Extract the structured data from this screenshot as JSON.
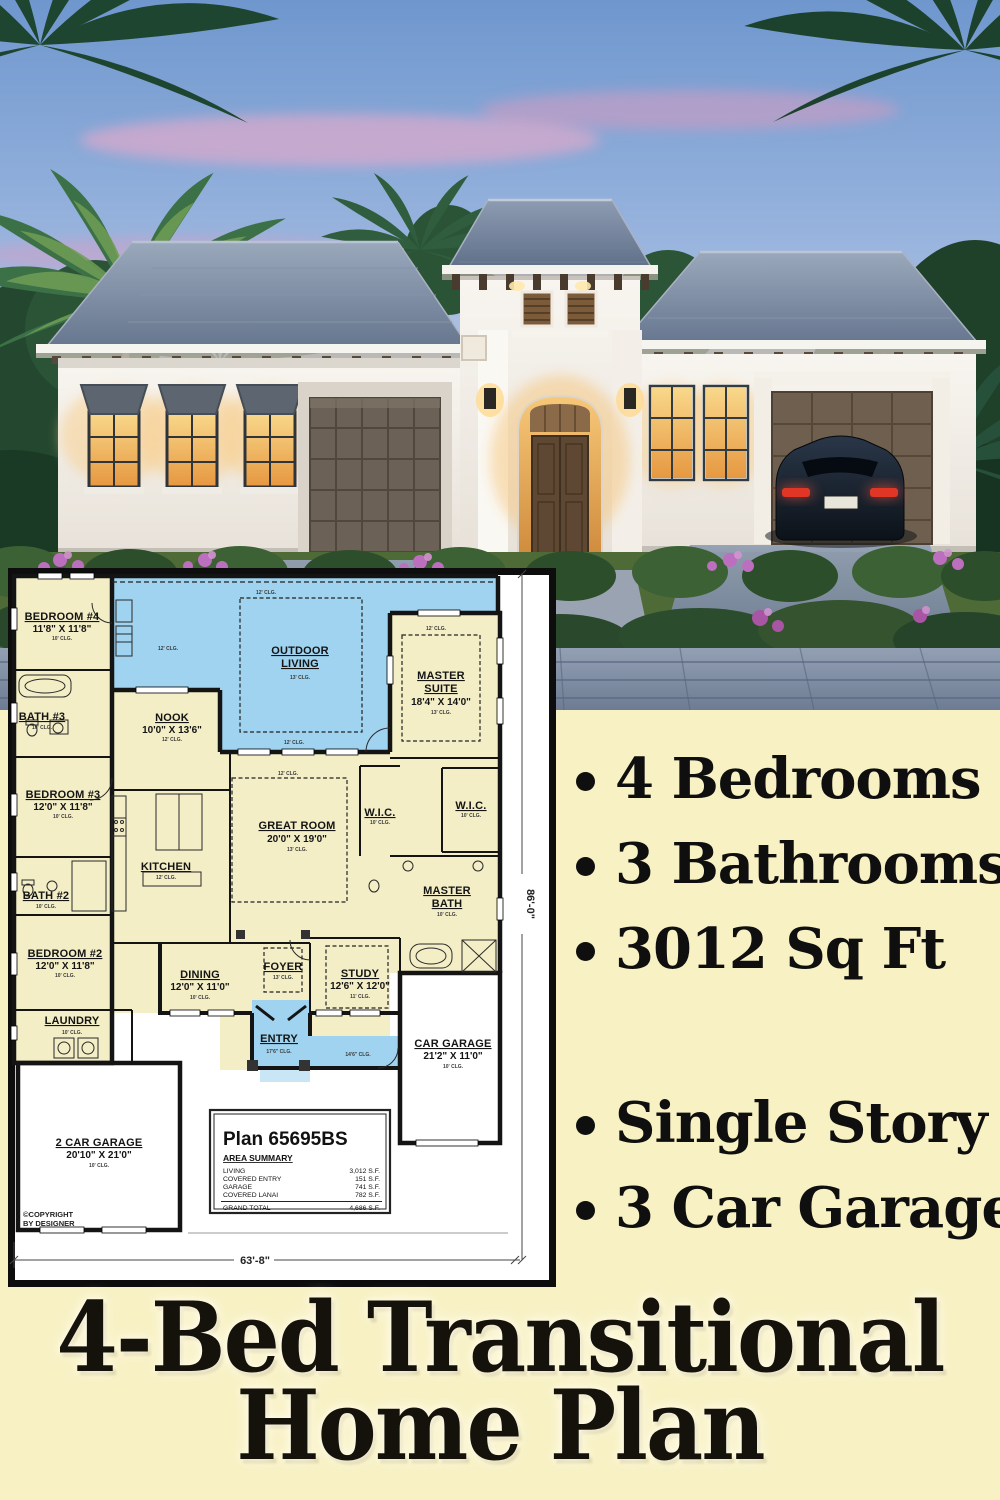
{
  "colors": {
    "background": "#f8f1c4",
    "plan_blue": "#9fd3ef",
    "plan_cream": "#f3eec6",
    "text": "#0f0f0f"
  },
  "features": {
    "primary": [
      "4 Bedrooms",
      "3 Bathrooms",
      "3012 Sq Ft"
    ],
    "secondary": [
      "Single Story",
      "3 Car Garage"
    ]
  },
  "title": {
    "line1": "4-Bed Transitional",
    "line2": "Home Plan"
  },
  "floorplan": {
    "plan_label": "Plan 65695BS",
    "area_summary_heading": "AREA SUMMARY",
    "areas": [
      {
        "label": "LIVING",
        "value": "3,012 S.F."
      },
      {
        "label": "COVERED ENTRY",
        "value": "151 S.F."
      },
      {
        "label": "GARAGE",
        "value": "741 S.F."
      },
      {
        "label": "COVERED LANAI",
        "value": "782 S.F."
      }
    ],
    "grand_total_label": "GRAND TOTAL",
    "grand_total_value": "4,686 S.F.",
    "copyright_line1": "©COPYRIGHT",
    "copyright_line2": "BY DESIGNER",
    "overall_width": "63'-8\"",
    "overall_depth": "86'-0\"",
    "hall_clg": "14'6\" CLG.",
    "misc_clg": "12' CLG.",
    "rooms": [
      {
        "name": "BEDROOM #4",
        "dims": "11'8\" X 11'8\"",
        "clg": "10' CLG."
      },
      {
        "name": "BATH #3",
        "dims": "",
        "clg": "10' CLG."
      },
      {
        "name": "BEDROOM #3",
        "dims": "12'0\" X 11'8\"",
        "clg": "10' CLG."
      },
      {
        "name": "BATH #2",
        "dims": "",
        "clg": "10' CLG."
      },
      {
        "name": "BEDROOM #2",
        "dims": "12'0\" X 11'8\"",
        "clg": "10' CLG."
      },
      {
        "name": "LAUNDRY",
        "dims": "",
        "clg": "10' CLG."
      },
      {
        "name": "2 CAR GARAGE",
        "dims": "20'10\" X 21'0\"",
        "clg": "10' CLG."
      },
      {
        "name": "NOOK",
        "dims": "10'0\" X 13'6\"",
        "clg": "12' CLG."
      },
      {
        "name": "KITCHEN",
        "dims": "",
        "clg": "12' CLG."
      },
      {
        "name": "OUTDOOR LIVING",
        "dims": "",
        "clg": "13' CLG."
      },
      {
        "name": "GREAT ROOM",
        "dims": "20'0\" X 19'0\"",
        "clg": "13' CLG."
      },
      {
        "name": "MASTER SUITE",
        "dims": "18'4\" X 14'0\"",
        "clg": "13' CLG."
      },
      {
        "name": "W.I.C.",
        "dims": "",
        "clg": "10' CLG."
      },
      {
        "name": "W.I.C.",
        "dims": "",
        "clg": "10' CLG."
      },
      {
        "name": "MASTER BATH",
        "dims": "",
        "clg": "10' CLG."
      },
      {
        "name": "DINING",
        "dims": "12'0\" X 11'0\"",
        "clg": "10' CLG."
      },
      {
        "name": "FOYER",
        "dims": "",
        "clg": "13' CLG."
      },
      {
        "name": "STUDY",
        "dims": "12'6\" X 12'0\"",
        "clg": "11' CLG."
      },
      {
        "name": "ENTRY",
        "dims": "",
        "clg": "17'6\" CLG."
      },
      {
        "name": "CAR GARAGE",
        "dims": "21'2\" X 11'0\"",
        "clg": "10' CLG."
      }
    ]
  }
}
